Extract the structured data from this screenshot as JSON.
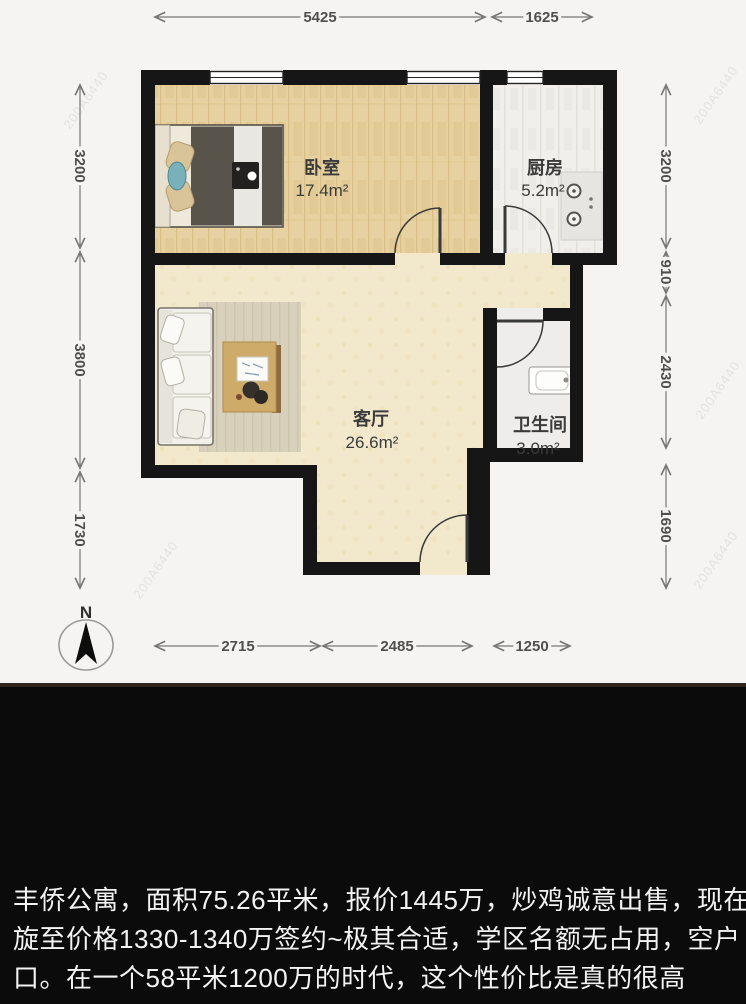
{
  "floorplan": {
    "rooms": [
      {
        "id": "bedroom",
        "name": "卧室",
        "area": "17.4m²"
      },
      {
        "id": "kitchen",
        "name": "厨房",
        "area": "5.2m²"
      },
      {
        "id": "living",
        "name": "客厅",
        "area": "26.6m²"
      },
      {
        "id": "bathroom",
        "name": "卫生间",
        "area": "3.0m²"
      }
    ],
    "dimensions": {
      "top": [
        "5425",
        "1625"
      ],
      "bottom": [
        "2715",
        "2485",
        "1250"
      ],
      "left": [
        "3200",
        "3800",
        "1730"
      ],
      "right": [
        "3200",
        "910",
        "2430",
        "1690"
      ]
    },
    "compass_label": "N",
    "watermark": "200A6440",
    "colors": {
      "wall": "#161616",
      "bedroom_floor": "#e7d1a0",
      "living_floor": "#f2e8cb",
      "kitchen_floor": "#f0efec",
      "plan_background": "#f6f4f2",
      "caption_background": "#0b0b0b",
      "caption_text": "#f3f3f3",
      "dimension_line": "#777777"
    }
  },
  "caption": {
    "lines": [
      "丰侨公寓，面积75.26平米，报价1445万，炒鸡诚意出售，现在斡",
      "旋至价格1330-1340万签约~极其合适，学区名额无占用，空户",
      "口。在一个58平米1200万的时代，这个性价比是真的很高"
    ]
  }
}
